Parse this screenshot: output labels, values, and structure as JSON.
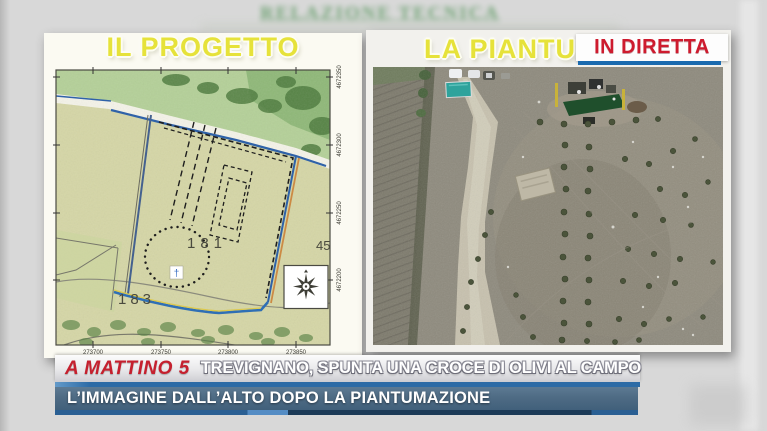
{
  "background": {
    "blurred_doc_title": "RELAZIONE TECNICA"
  },
  "left_panel": {
    "title": "IL PROGETTO",
    "map": {
      "parcel_181": "181",
      "parcel_183": "183",
      "parcel_45": "45",
      "cross_symbol": "†",
      "x_ticks": [
        "273700",
        "273750",
        "273800",
        "273850"
      ],
      "y_ticks": [
        "4672350",
        "4672300",
        "4672250",
        "4672200"
      ]
    }
  },
  "right_panel": {
    "title_partial": "LA PIANTUMA",
    "live_badge": "IN DIRETTA"
  },
  "lower_thirds": {
    "brand": "A MATTINO 5",
    "headline": "TREVIGNANO, SPUNTA UNA CROCE DI OLIVI AL CAMPO",
    "subheadline": "L’IMMAGINE DALL’ALTO DOPO LA PIANTUMAZIONE"
  },
  "colors": {
    "title_yellow": "#e6e23a",
    "live_red": "#ce1b2e",
    "live_bar_blue": "#1a6aaf",
    "brand_red": "#c5202e",
    "banner2_slate": "#4e6b84",
    "divider_blue": "#2d6ba6"
  }
}
